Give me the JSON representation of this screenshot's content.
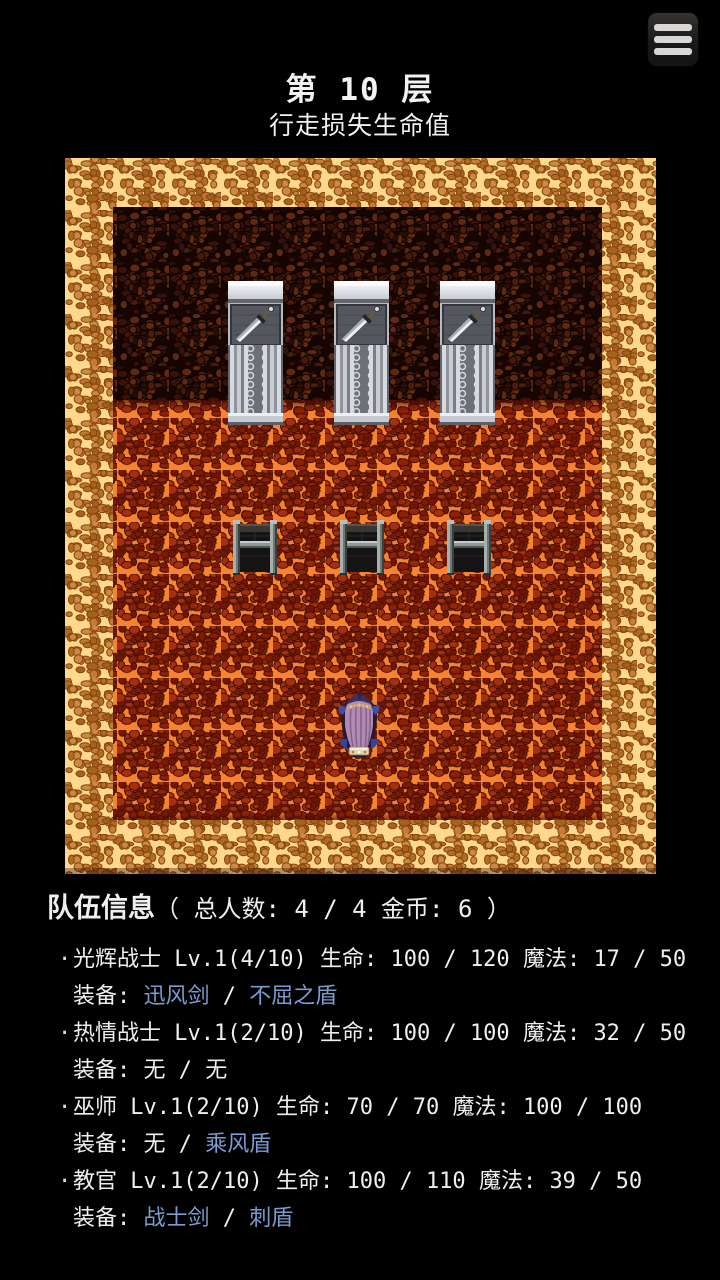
{
  "header": {
    "title": "第 10 层",
    "subtitle": "行走损失生命值"
  },
  "menu": {
    "icon": "hamburger-menu"
  },
  "map": {
    "theme": "lava-dungeon",
    "doors": [
      "sword-door",
      "sword-door",
      "sword-door"
    ],
    "chests": [
      "iron-chest",
      "iron-chest",
      "iron-chest"
    ],
    "player": "hero-back-view",
    "colors": {
      "border_grout": "#ffd88e",
      "border_pebble": "#c57d33",
      "wall_base": "#170502",
      "wall_pebble": "#4e1e0b",
      "floor_crack": "#f5832f",
      "floor_pebble": "#7c1c07"
    }
  },
  "party": {
    "title": "队伍信息",
    "summary": "（ 总人数: 4 / 4 金币: 6 ）",
    "bullet": "·",
    "separator": "/",
    "colors": {
      "link_blue": "#7b9cd0",
      "text": "#efefef"
    },
    "members": [
      {
        "name": "光辉战士",
        "level": "Lv.1(4/10)",
        "hp_label": "生命:",
        "hp": "100 / 120",
        "mp_label": "魔法:",
        "mp": "17 / 50",
        "equip_label": "装备:",
        "weapon": "迅风剑",
        "weapon_class": "eq-link",
        "shield": "不屈之盾",
        "shield_class": "eq-link"
      },
      {
        "name": "热情战士",
        "level": "Lv.1(2/10)",
        "hp_label": "生命:",
        "hp": "100 / 100",
        "mp_label": "魔法:",
        "mp": "32 / 50",
        "equip_label": "装备:",
        "weapon": "无",
        "weapon_class": "eq-plain",
        "shield": "无",
        "shield_class": "eq-plain"
      },
      {
        "name": "巫师",
        "level": "Lv.1(2/10)",
        "hp_label": "生命:",
        "hp": "70 / 70",
        "mp_label": "魔法:",
        "mp": "100 / 100",
        "equip_label": "装备:",
        "weapon": "无",
        "weapon_class": "eq-plain",
        "shield": "乘风盾",
        "shield_class": "eq-link"
      },
      {
        "name": "教官",
        "level": "Lv.1(2/10)",
        "hp_label": "生命:",
        "hp": "100 / 110",
        "mp_label": "魔法:",
        "mp": "39 / 50",
        "equip_label": "装备:",
        "weapon": "战士剑",
        "weapon_class": "eq-link",
        "shield": "刺盾",
        "shield_class": "eq-link"
      }
    ]
  }
}
